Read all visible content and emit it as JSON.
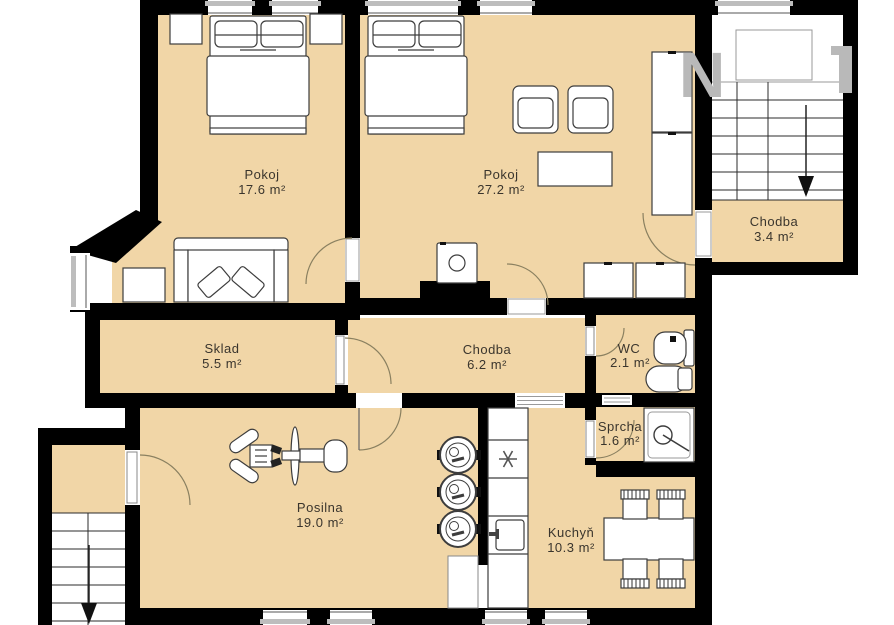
{
  "plan_title": "Apartment floor plan",
  "watermark": {
    "partial_letter_left": "N",
    "partial_letter_right": "T"
  },
  "colors": {
    "floor": "#f1d6a7",
    "wall": "#000000",
    "furniture_fill": "#ffffff",
    "furniture_stroke": "#3d3d3d",
    "window_sill": "#bdbdbd",
    "door_arc": "#8a8060",
    "watermark_gray": "#b9b9b9",
    "label_text": "#3a352d"
  },
  "rooms": [
    {
      "id": "pokoj-1",
      "name": "Pokoj",
      "area": "17.6 m²"
    },
    {
      "id": "pokoj-2",
      "name": "Pokoj",
      "area": "27.2 m²"
    },
    {
      "id": "chodba-3",
      "name": "Chodba",
      "area": "3.4 m²"
    },
    {
      "id": "sklad",
      "name": "Sklad",
      "area": "5.5 m²"
    },
    {
      "id": "chodba-6",
      "name": "Chodba",
      "area": "6.2 m²"
    },
    {
      "id": "wc",
      "name": "WC",
      "area": "2.1 m²"
    },
    {
      "id": "sprcha",
      "name": "Sprcha",
      "area": "1.6 m²"
    },
    {
      "id": "posilna",
      "name": "Posilna",
      "area": "19.0 m²"
    },
    {
      "id": "kuchyn",
      "name": "Kuchyň",
      "area": "10.3 m²"
    }
  ]
}
